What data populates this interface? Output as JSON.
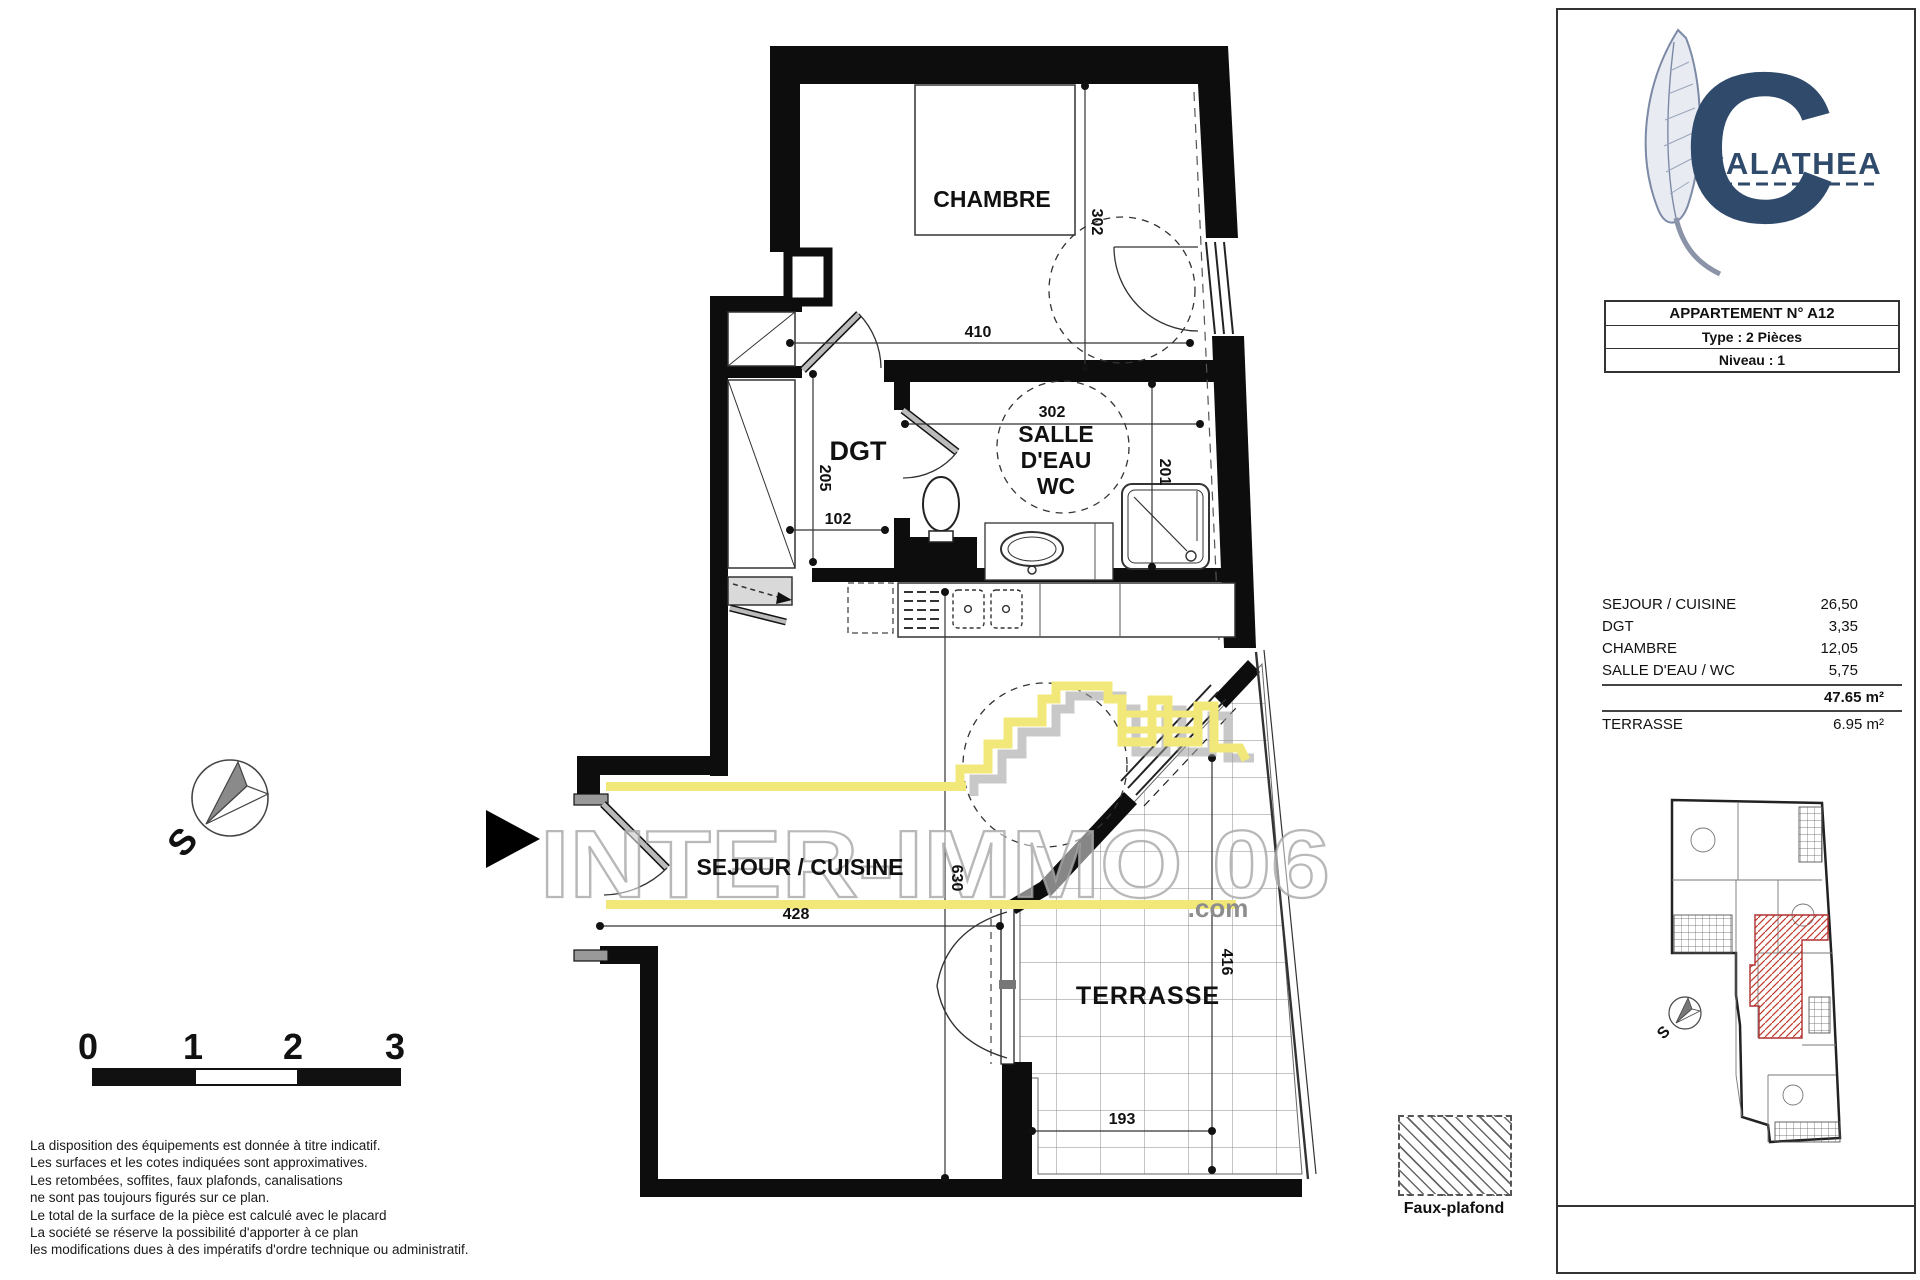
{
  "colors": {
    "accent_yellow": "#f2e87a",
    "brand_navy": "#2f4a6b",
    "unit_red": "#c0392b"
  },
  "watermark": {
    "text": "INTER-IMMO 06",
    "domain_suffix": ".com"
  },
  "plan": {
    "rooms": {
      "chambre": "CHAMBRE",
      "dgt": "DGT",
      "salle_line1": "SALLE",
      "salle_line2": "D'EAU",
      "salle_line3": "WC",
      "sejour": "SEJOUR / CUISINE",
      "terrasse": "TERRASSE"
    },
    "dims": {
      "chambre_w": "410",
      "chambre_h": "302",
      "bath_w": "302",
      "bath_h": "201",
      "dgt_h": "205",
      "dgt_w": "102",
      "sejour_h": "630",
      "sejour_w": "428",
      "terrasse_h": "416",
      "terrasse_w": "193"
    },
    "compass_label": "S"
  },
  "panel": {
    "brand": "CALATHEA",
    "info": {
      "title": "APPARTEMENT N° A12",
      "type": "Type : 2 Pièces",
      "level": "Niveau : 1"
    },
    "areas": {
      "rows": [
        {
          "label": "SEJOUR / CUISINE",
          "value": "26,50"
        },
        {
          "label": "DGT",
          "value": "3,35"
        },
        {
          "label": "CHAMBRE",
          "value": "12,05"
        },
        {
          "label": "SALLE D'EAU / WC",
          "value": "5,75"
        }
      ],
      "total": "47.65 m²",
      "terrace_label": "TERRASSE",
      "terrace_value": "6.95 m²"
    },
    "mini_compass": "S"
  },
  "scalebar": {
    "ticks": [
      "0",
      "1",
      "2",
      "3"
    ]
  },
  "legend": {
    "label": "Faux-plafond"
  },
  "disclaimer": {
    "lines": [
      "La disposition des équipements est donnée à titre indicatif.",
      "Les surfaces et les cotes indiquées sont approximatives.",
      "Les retombées, soffites, faux plafonds, canalisations",
      "ne sont pas toujours figurés  sur ce plan.",
      "Le total de la surface de la pièce est calculé avec le placard",
      "La société se réserve la possibilité d'apporter à ce plan",
      "les modifications dues à des impératifs d'ordre technique ou administratif."
    ]
  }
}
